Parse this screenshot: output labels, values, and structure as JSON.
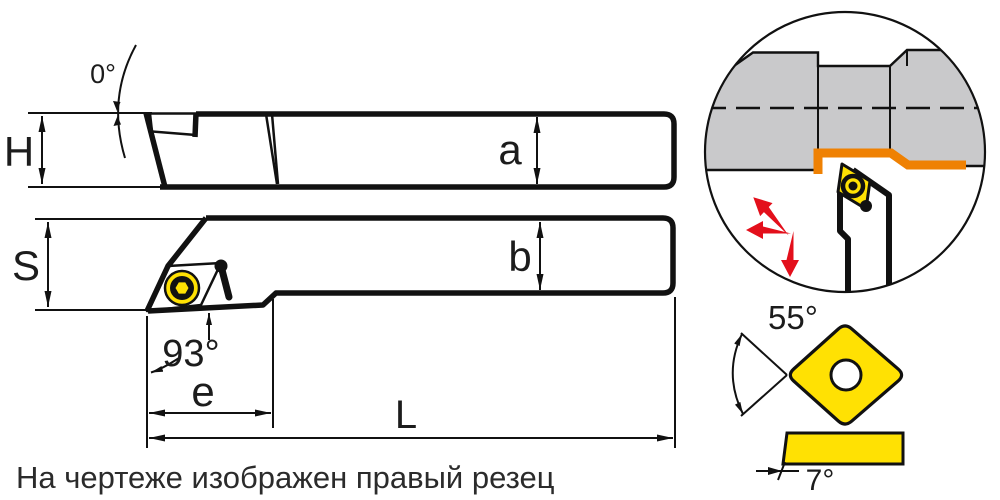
{
  "note": "На чертеже изображен правый резец",
  "labels": {
    "rake_angle": "0°",
    "holder_height": "H",
    "insert_seat_height": "a",
    "shank_width": "S",
    "insert_seat_width": "b",
    "entering_angle": "93°",
    "head_length": "e",
    "overall_length": "L",
    "insert_point_angle": "55°",
    "insert_clearance_angle": "7°"
  },
  "colors": {
    "insert_yellow": "#ffe103",
    "machined_surface_orange": "#ef8103",
    "workpiece_gray": "#c9c9cb",
    "feed_arrow_red": "#e30f1b",
    "line_black": "#111111"
  }
}
